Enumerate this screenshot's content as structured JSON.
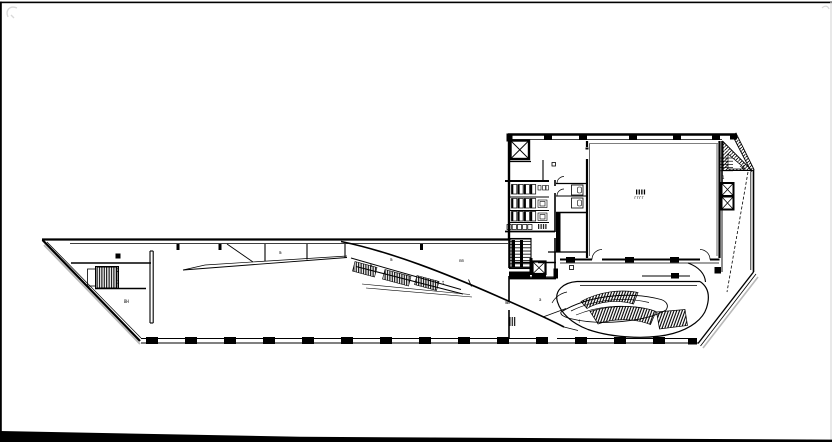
{
  "canvas": {
    "subject": "architectural floor plan line drawing",
    "background": "#ffffff",
    "ink": "#000000",
    "shadow": "#b9b9b9",
    "faint": "#d9d9d9"
  },
  "plan": {
    "annotations": {
      "stair_west_upper": "2",
      "stair_west_lower": "3",
      "room_west": "BH",
      "wedge_label": "m",
      "escalator_top": "m",
      "escalator_mid": "B",
      "escalator_end": "t",
      "hall_lobby": "nm",
      "core_side": "mm",
      "hall_center": "rrrr",
      "stair_east": "1",
      "amphitheater": "f",
      "amphitheater_left": "a"
    }
  }
}
